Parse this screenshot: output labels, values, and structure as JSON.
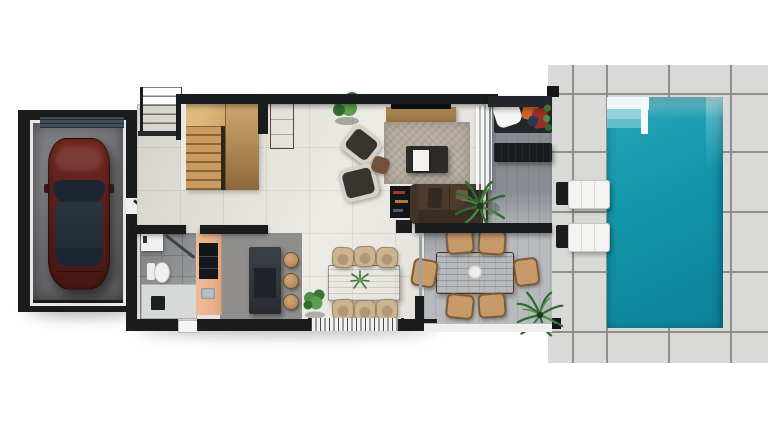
{
  "palette": {
    "bg": "#ffffff",
    "wall": "#191b1d",
    "paver": "#d9d9d7",
    "paver-joint": "#8f8f8d",
    "pool-water": "#1396ab",
    "pool-water-deep": "#0d8199",
    "pool-step": "#eef7f8",
    "house-floor": "#e9e6e0",
    "terrace-deck": "#b7babc",
    "garage-floor": "#717275",
    "garage-door": "#3f4d5a",
    "car-body": "#5e211d",
    "car-glass": "#1d2734",
    "stair-wood": "#c59a63",
    "kitchen-cabinet": "#e7b28d",
    "island": "#31363b",
    "rug": "#b3ab9d",
    "sofa": "#4c3b2d",
    "wood-table": "#6f4731",
    "outdoor-table": "#8a4a2c",
    "chair-tan": "#c89a6a",
    "chair-beige": "#ccb492",
    "plant-green": "#4e8f44",
    "plant-green-dark": "#2e6b33",
    "lounger": "#f3f3f1",
    "towel-orange": "#d2622f",
    "towel-red": "#9e2e23",
    "fixture": "#f1f0ee",
    "bath-floor": "#999b9d"
  },
  "scene": {
    "view": "top-down 3D floor plan render, ground floor with pool",
    "areas": [
      "pool-deck",
      "swimming-pool",
      "covered-terrace",
      "living-room",
      "dining-room",
      "kitchen",
      "bathroom",
      "entry-stairs",
      "garage"
    ],
    "object_counts": {
      "cars": 1,
      "sun_loungers": 2,
      "deck_pillars": 2,
      "armchairs": 2,
      "sofas": 2,
      "indoor_dining_chairs": 6,
      "outdoor_dining_chairs": 6,
      "bar_stools": 3,
      "plants": 5,
      "toilets": 1,
      "showers": 1
    }
  }
}
